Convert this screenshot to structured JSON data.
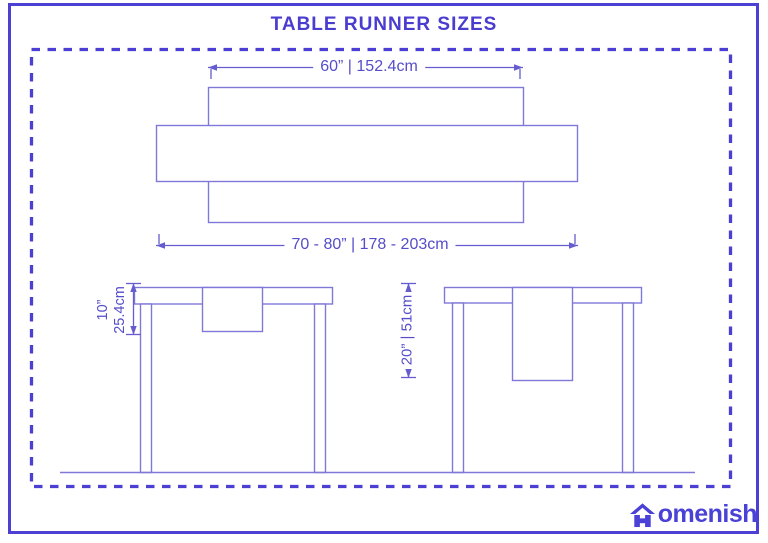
{
  "title": "TABLE RUNNER SIZES",
  "top_view": {
    "table_width_label": "60” | 152.4cm",
    "runner_length_label": "70 - 80” | 178 - 203cm"
  },
  "side_view_short": {
    "drop_label_in": "10”",
    "drop_label_cm": "25.4cm"
  },
  "side_view_long": {
    "drop_label": "20” | 51cm"
  },
  "logo": {
    "brand": "Homenish",
    "icon": "house-icon",
    "text_after_icon": "omenish"
  },
  "colors": {
    "accent": "#4b40d3",
    "drawing_line": "#8078d8",
    "dimension_line": "#655cd0",
    "dimension_text": "#554dc9",
    "logo": "#4a41d6",
    "background": "#ffffff"
  }
}
